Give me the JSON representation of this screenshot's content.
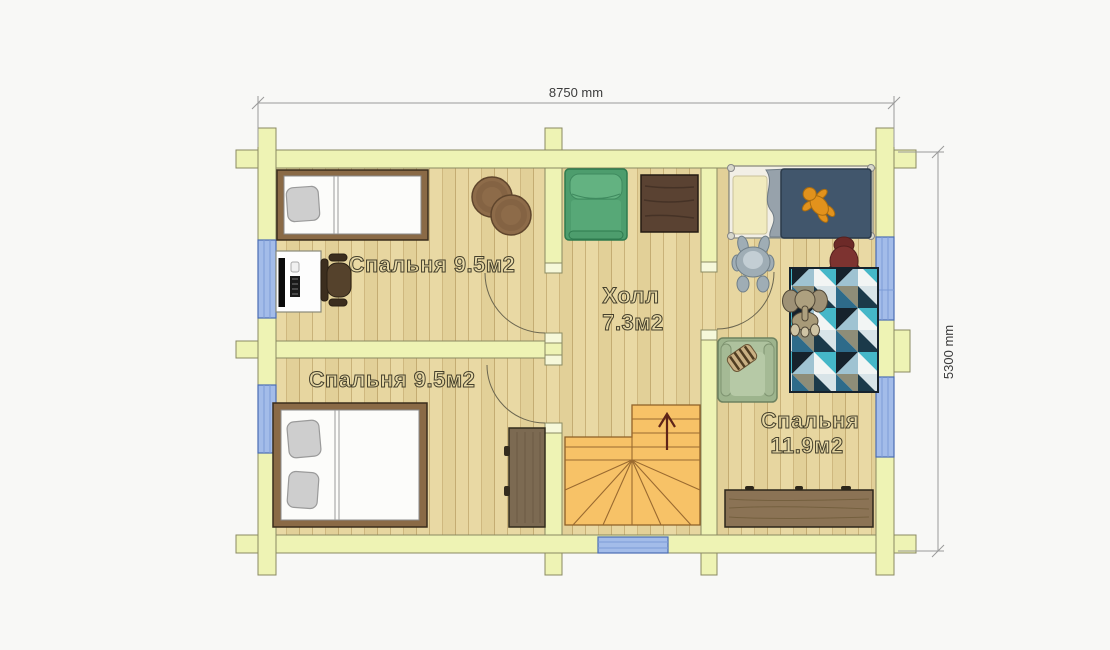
{
  "plan_type": "floor-plan",
  "dimensions": {
    "width_label": "8750 mm",
    "height_label": "5300 mm"
  },
  "rooms": {
    "bedroom_top_left": {
      "label": "Спальня 9.5м2"
    },
    "bedroom_bottom_left": {
      "label": "Спальня 9.5м2"
    },
    "hall": {
      "name": "Холл",
      "area": "7.3м2"
    },
    "bedroom_right": {
      "name": "Спальня",
      "area": "11.9м2"
    }
  },
  "stairs": {
    "direction": "up"
  },
  "furniture": [
    "single-bed",
    "desk-with-computer",
    "office-chair",
    "round-jute-rugs",
    "double-bed",
    "wardrobe",
    "green-armchair",
    "dark-wood-table",
    "staircase",
    "child-bed",
    "plush-toy-gray",
    "plush-toy-red",
    "orange-toy",
    "geometric-rug",
    "elephant-toy",
    "sage-armchair",
    "striped-pillow",
    "sideboard"
  ],
  "colors": {
    "wall": "#eef3b4",
    "wall_outline": "#8a8a62",
    "floor": "#e8d8a2",
    "plank_line": "#c9b279",
    "window": "#a3bce9",
    "window_frame": "#4a6db3",
    "stairs": "#f7c267",
    "stair_line": "#8d5f26",
    "arrow": "#5f2418",
    "dimension_line": "#9a9a9a",
    "label_outline": "#45402c"
  }
}
